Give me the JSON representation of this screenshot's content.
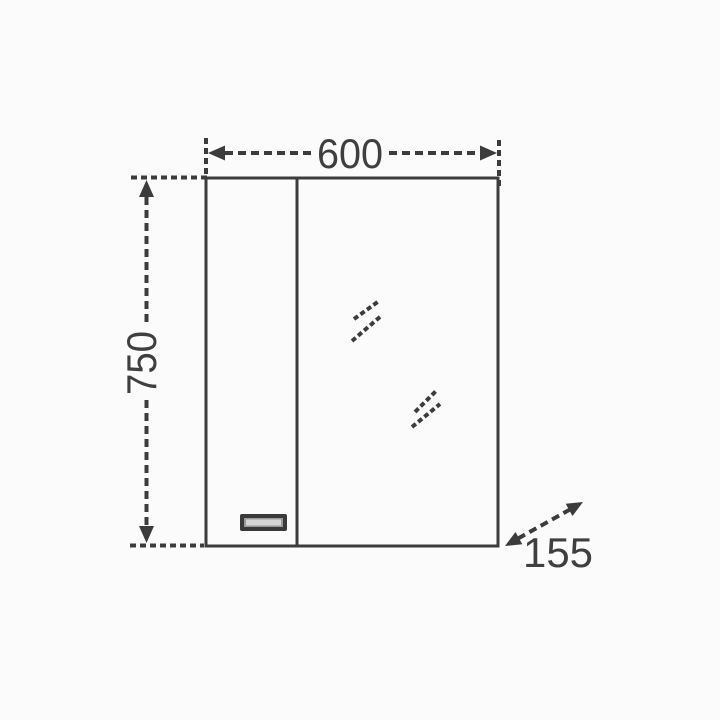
{
  "diagram": {
    "type": "technical-dimension-drawing",
    "subject": "mirrored bathroom cabinet front view",
    "dimensions": {
      "width": {
        "value": "600",
        "orientation": "horizontal-top"
      },
      "height": {
        "value": "750",
        "orientation": "vertical-left"
      },
      "depth": {
        "value": "155",
        "orientation": "diagonal-bottom-right"
      }
    },
    "parts": {
      "left_door_with_handle": true,
      "mirror_panel_with_shine_marks": true
    },
    "colors": {
      "background": "#fbfbfb",
      "line": "#3c3c3c",
      "text": "#3f3f3f",
      "handle_frame": "#3a3a3a",
      "handle_fill": "#9a9a9a",
      "handle_highlight": "#d6d6d6"
    }
  }
}
